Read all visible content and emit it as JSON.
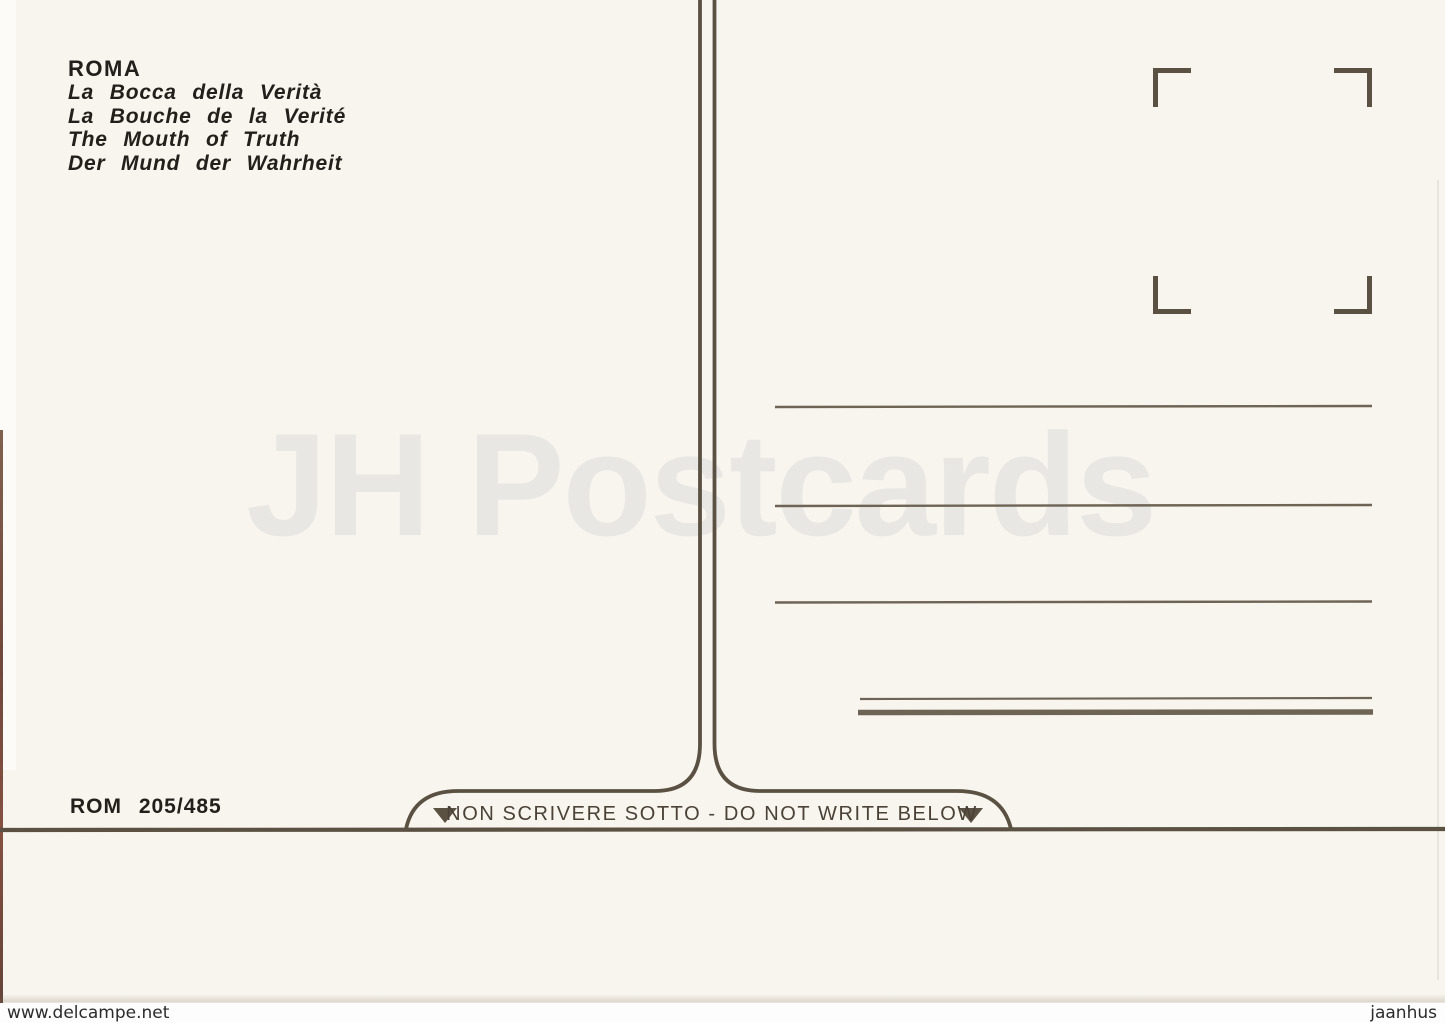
{
  "postcard": {
    "title": "ROMA",
    "subtitles": [
      "La Bocca della Verità",
      "La Bouche de la Verité",
      "The Mouth of Truth",
      "Der Mund der Wahrheit"
    ],
    "catalog_number": "ROM 205/485",
    "banner_text": "NON SCRIVERE SOTTO - DO NOT WRITE BELOW",
    "watermark_text": "JH Postcards"
  },
  "scan_labels": {
    "bottom_left": "www.delcampe.net",
    "bottom_right": "jaanhus"
  },
  "icons": {
    "stamp_corners": "stamp-placement-corner-marks",
    "banner_arrows": "down-triangle-icon"
  },
  "colors": {
    "ink": "#5a5143",
    "address_line_ink": "#6d6455",
    "card_background": "#f8f5ee",
    "watermark_gray": "#e8e7e4",
    "text_black": "#23201c",
    "banner_text": "#4a4236"
  }
}
